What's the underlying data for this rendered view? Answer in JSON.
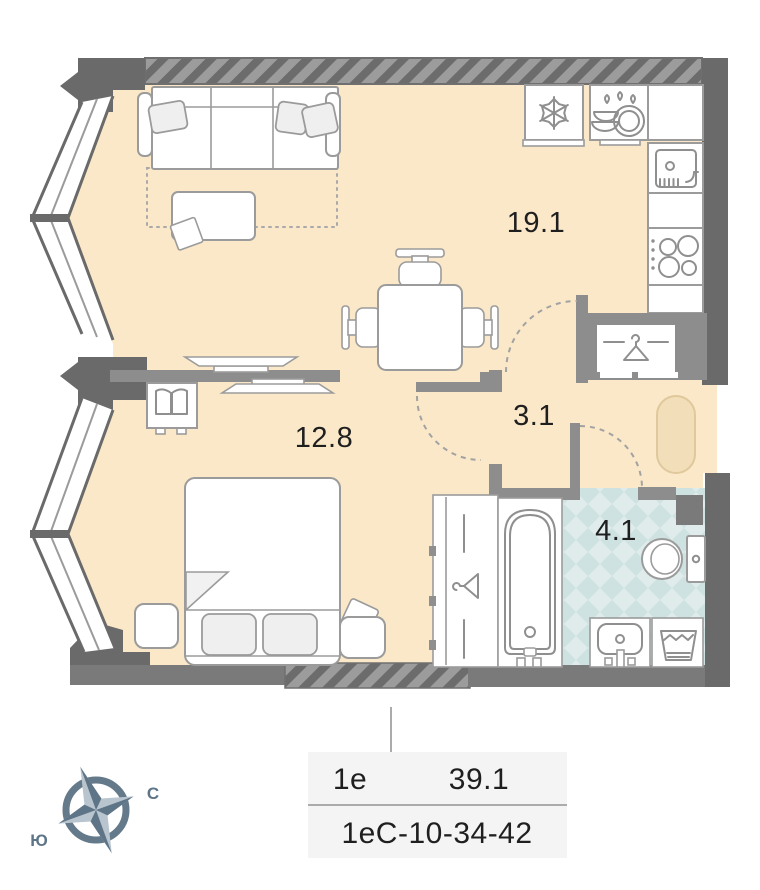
{
  "palette": {
    "floor": "#FAE8C8",
    "tile_light": "#DFECEB",
    "tile_dark": "#CDE2E1",
    "wall_dark": "#6A6A6A",
    "wall_mid": "#8D8D8D",
    "furniture_line": "#9B9B9B",
    "text": "#1F1F1F",
    "compass": "#5E7487",
    "compass_light": "#B9C5CE",
    "doormat": "#F2DFBA",
    "doormat_border": "#DFC89C",
    "table_bg": "#F4F4F4"
  },
  "rooms": {
    "kitchen_living": {
      "label": "19.1"
    },
    "bedroom": {
      "label": "12.8"
    },
    "hallway": {
      "label": "3.1"
    },
    "bathroom": {
      "label": "4.1"
    }
  },
  "info_table": {
    "layout_type": "1е",
    "total_area": "39.1",
    "unit_code": "1еС-10-34-42"
  },
  "compass": {
    "north_label": "С",
    "south_label": "Ю"
  },
  "icons": {
    "fridge": "snowflake-icon",
    "dishwasher": "dishes-drops-icon",
    "wardrobe": "hanger-icon",
    "closet": "hanger-icon",
    "nightstand": "open-book-icon"
  }
}
